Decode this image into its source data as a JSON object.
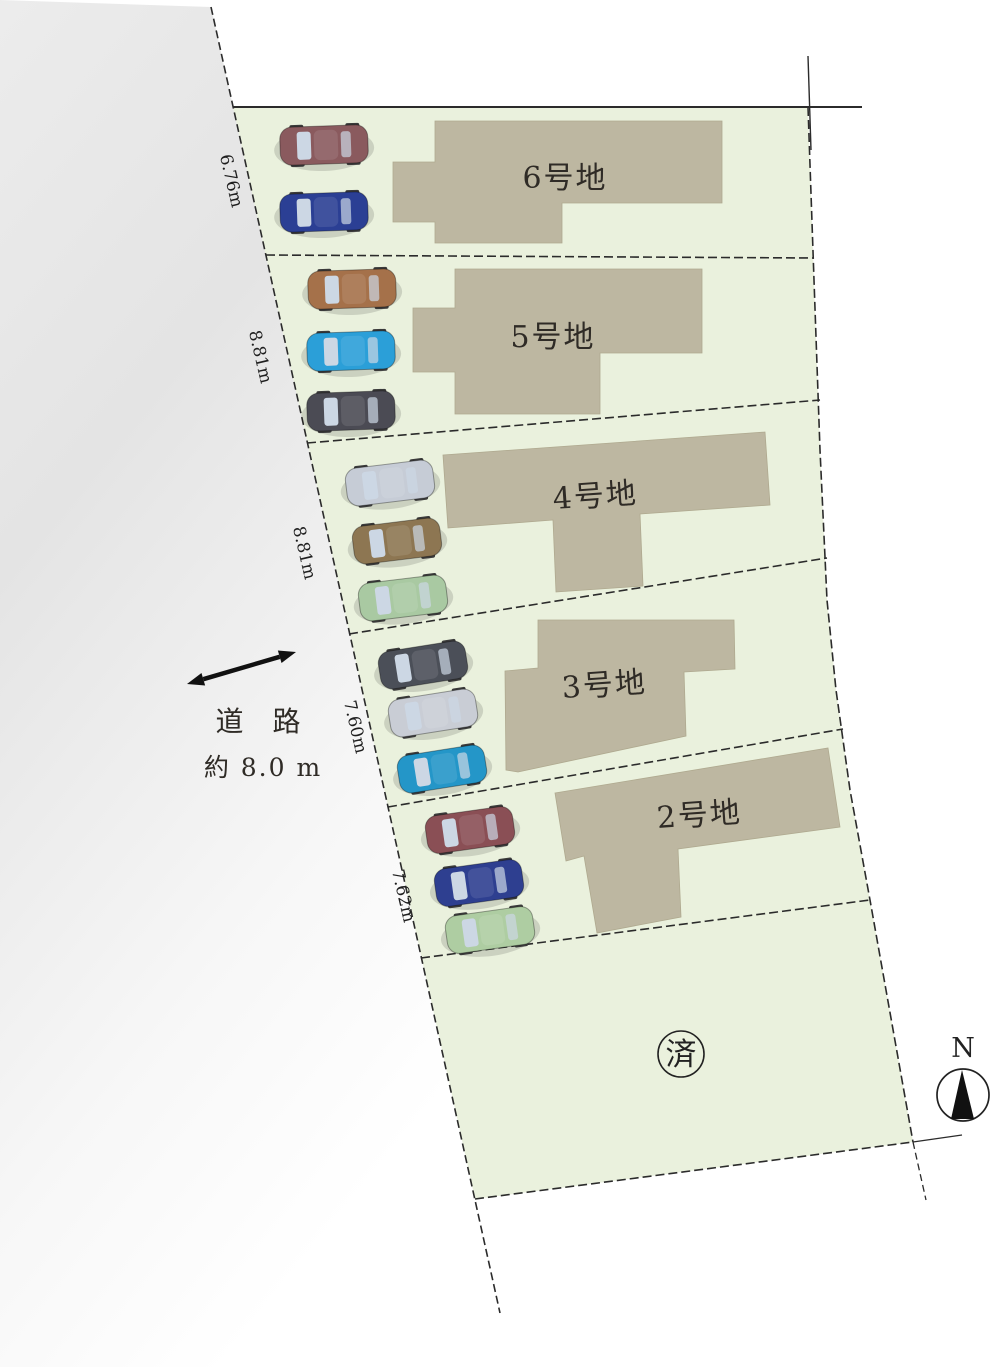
{
  "canvas": {
    "width": 1000,
    "height": 1367,
    "background": "#ffffff"
  },
  "colors": {
    "lot_green": "#eaf1dd",
    "building_tan": "#bdb7a1",
    "building_edge": "#aFa98f",
    "line_dark": "#2b2b2b",
    "road_gray": "#e4e4e4",
    "text_dark": "#2f2b26",
    "glass": "#ccd7e4",
    "wheel": "#3a3a3a"
  },
  "road": {
    "label_line1": "道 路",
    "label_line2": "約 8.0 m",
    "label1_pos": {
      "x": 263,
      "y": 731
    },
    "label2_pos": {
      "x": 263,
      "y": 776
    },
    "arrow": {
      "x1": 187,
      "y1": 684,
      "x2": 296,
      "y2": 652
    },
    "polygon": [
      [
        0,
        0
      ],
      [
        211,
        7
      ],
      [
        500,
        1313
      ],
      [
        470,
        1367
      ],
      [
        0,
        1367
      ]
    ]
  },
  "site": {
    "perimeter": [
      [
        233,
        107
      ],
      [
        808,
        107
      ],
      [
        814,
        280
      ],
      [
        820,
        450
      ],
      [
        827,
        600
      ],
      [
        836,
        690
      ],
      [
        850,
        790
      ],
      [
        870,
        900
      ],
      [
        913,
        1142
      ],
      [
        475,
        1199
      ]
    ],
    "left_boundary": {
      "x1": 211,
      "y1": 7,
      "x2": 500,
      "y2": 1313
    },
    "right_boundary": [
      [
        808,
        107
      ],
      [
        814,
        280
      ],
      [
        820,
        450
      ],
      [
        827,
        600
      ],
      [
        836,
        690
      ],
      [
        850,
        790
      ],
      [
        870,
        900
      ],
      [
        913,
        1142
      ]
    ],
    "bottom_boundary": {
      "x1": 475,
      "y1": 1199,
      "x2": 913,
      "y2": 1142
    },
    "top_boundary": {
      "x1": 233,
      "y1": 107,
      "x2": 862,
      "y2": 107
    },
    "survey_tick_top": {
      "x1": 808,
      "y1": 56,
      "x2": 811,
      "y2": 150
    },
    "ext_bottom_right_h": {
      "x1": 913,
      "y1": 1142,
      "x2": 962,
      "y2": 1135
    },
    "ext_bottom_right_v": {
      "x1": 913,
      "y1": 1142,
      "x2": 926,
      "y2": 1200
    },
    "dividers": [
      [
        [
          266,
          255
        ],
        [
          814,
          258
        ]
      ],
      [
        [
          307,
          443
        ],
        [
          820,
          400
        ]
      ],
      [
        [
          349,
          634
        ],
        [
          827,
          558
        ]
      ],
      [
        [
          388,
          807
        ],
        [
          843,
          729
        ]
      ],
      [
        [
          421,
          958
        ],
        [
          870,
          900
        ]
      ]
    ]
  },
  "lots": [
    {
      "label": "6号地",
      "label_pos": {
        "x": 565,
        "y": 188
      },
      "label_angle": 0,
      "frontage": {
        "text": "6.76m",
        "x": 226,
        "y": 182,
        "angle": 77
      },
      "building": [
        [
          435,
          121
        ],
        [
          722,
          121
        ],
        [
          722,
          203
        ],
        [
          562,
          203
        ],
        [
          562,
          243
        ],
        [
          435,
          243
        ],
        [
          435,
          222
        ],
        [
          393,
          222
        ],
        [
          393,
          162
        ],
        [
          435,
          162
        ]
      ],
      "cars": [
        {
          "name": "maroon-car",
          "x": 324,
          "y": 145,
          "angle": -2,
          "color": "#8a5a5e"
        },
        {
          "name": "blue-car",
          "x": 324,
          "y": 212,
          "angle": -2,
          "color": "#2b3f94"
        }
      ]
    },
    {
      "label": "5号地",
      "label_pos": {
        "x": 553,
        "y": 347
      },
      "label_angle": 0,
      "frontage": {
        "text": "8.81m",
        "x": 255,
        "y": 358,
        "angle": 77
      },
      "building": [
        [
          455,
          269
        ],
        [
          702,
          269
        ],
        [
          702,
          353
        ],
        [
          600,
          353
        ],
        [
          600,
          414
        ],
        [
          455,
          414
        ],
        [
          455,
          372
        ],
        [
          413,
          372
        ],
        [
          413,
          308
        ],
        [
          455,
          308
        ]
      ],
      "cars": [
        {
          "name": "brown-car",
          "x": 352,
          "y": 289,
          "angle": -2,
          "color": "#a5714a"
        },
        {
          "name": "light-blue-car",
          "x": 351,
          "y": 351,
          "angle": -2,
          "color": "#2b9fd8"
        },
        {
          "name": "dark-gray-car",
          "x": 351,
          "y": 411,
          "angle": -2,
          "color": "#4b4b54"
        }
      ]
    },
    {
      "label": "4号地",
      "label_pos": {
        "x": 596,
        "y": 506
      },
      "label_angle": -4,
      "frontage": {
        "text": "8.81m",
        "x": 299,
        "y": 554,
        "angle": 77
      },
      "building": [
        [
          443,
          455
        ],
        [
          765,
          432
        ],
        [
          770,
          505
        ],
        [
          640,
          514
        ],
        [
          643,
          586
        ],
        [
          556,
          592
        ],
        [
          553,
          520
        ],
        [
          448,
          528
        ]
      ],
      "cars": [
        {
          "name": "silver-car",
          "x": 390,
          "y": 483,
          "angle": -7,
          "color": "#c6ccd6"
        },
        {
          "name": "khaki-car",
          "x": 397,
          "y": 541,
          "angle": -7,
          "color": "#8d7652"
        },
        {
          "name": "light-green-car",
          "x": 403,
          "y": 598,
          "angle": -7,
          "color": "#a9c9a2"
        }
      ]
    },
    {
      "label": "3号地",
      "label_pos": {
        "x": 605,
        "y": 695
      },
      "label_angle": -4,
      "frontage": {
        "text": "7.60m",
        "x": 350,
        "y": 728,
        "angle": 77
      },
      "building": [
        [
          538,
          620
        ],
        [
          734,
          620
        ],
        [
          735,
          669
        ],
        [
          684,
          672
        ],
        [
          686,
          736
        ],
        [
          518,
          772
        ],
        [
          506,
          770
        ],
        [
          505,
          671
        ],
        [
          538,
          668
        ]
      ],
      "cars": [
        {
          "name": "dark-gray-car",
          "x": 423,
          "y": 665,
          "angle": -9,
          "color": "#4b4f58"
        },
        {
          "name": "silver-car",
          "x": 433,
          "y": 713,
          "angle": -9,
          "color": "#c9cdd5"
        },
        {
          "name": "teal-car",
          "x": 442,
          "y": 769,
          "angle": -9,
          "color": "#2496c8"
        }
      ]
    },
    {
      "label": "2号地",
      "label_pos": {
        "x": 700,
        "y": 825
      },
      "label_angle": -4,
      "frontage": {
        "text": "7.62m",
        "x": 398,
        "y": 897,
        "angle": 77
      },
      "building": [
        [
          555,
          793
        ],
        [
          828,
          748
        ],
        [
          840,
          827
        ],
        [
          678,
          849
        ],
        [
          681,
          917
        ],
        [
          597,
          933
        ],
        [
          584,
          856
        ],
        [
          566,
          861
        ]
      ],
      "cars": [
        {
          "name": "maroon-car",
          "x": 470,
          "y": 830,
          "angle": -8,
          "color": "#8a4f55"
        },
        {
          "name": "dark-blue-car",
          "x": 479,
          "y": 883,
          "angle": -8,
          "color": "#2e3f90"
        },
        {
          "name": "light-green-car",
          "x": 490,
          "y": 930,
          "angle": -8,
          "color": "#aecda2"
        }
      ]
    }
  ],
  "sold_lot": {
    "label": "済",
    "x": 681,
    "y": 1054,
    "r": 23
  },
  "compass": {
    "label": "N",
    "x": 963,
    "label_y": 1057,
    "cy": 1095,
    "r": 26
  }
}
